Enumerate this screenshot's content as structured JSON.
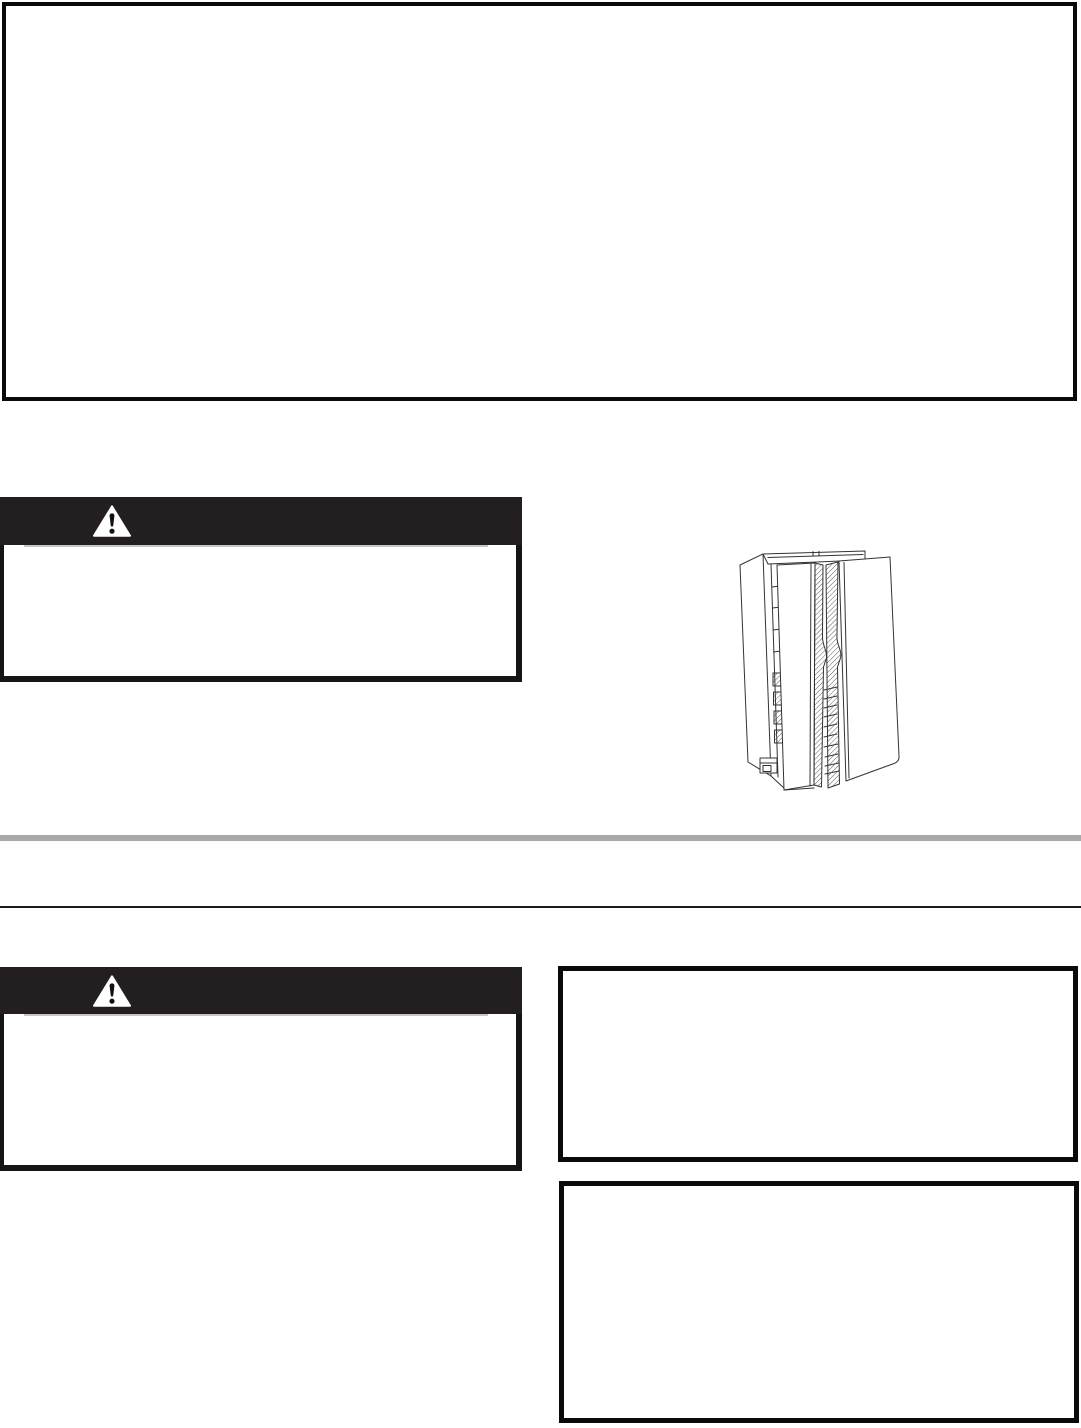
{
  "page": {
    "kind": "appliance-manual-page",
    "background": "#ffffff",
    "width_px": 1081,
    "height_px": 1428
  },
  "colors": {
    "box_border": "#0a0a0a",
    "warning_banner_bg": "#231f20",
    "warning_triangle_fill": "#ffffff",
    "warning_triangle_mark": "#111111",
    "banner_underline_gray": "#c6c6c6",
    "divider_gray": "#a8a8a8",
    "divider_black": "#1b1b1b",
    "line_art_stroke": "#333333"
  },
  "top_box": {
    "text": ""
  },
  "left_column": {
    "warning_box_upper": {
      "icon": "warning-triangle-icon",
      "banner_text": "",
      "body_text": ""
    },
    "warning_box_lower": {
      "icon": "warning-triangle-icon",
      "banner_text": "",
      "body_text": ""
    }
  },
  "right_column": {
    "illustration": {
      "name": "side-by-side-refrigerator-both-doors-open",
      "style": "black-and-white line art"
    },
    "box_upper": {
      "text": ""
    },
    "box_lower": {
      "text": ""
    }
  },
  "dividers": {
    "thick_gray_rule": true,
    "thin_black_rule": true
  }
}
